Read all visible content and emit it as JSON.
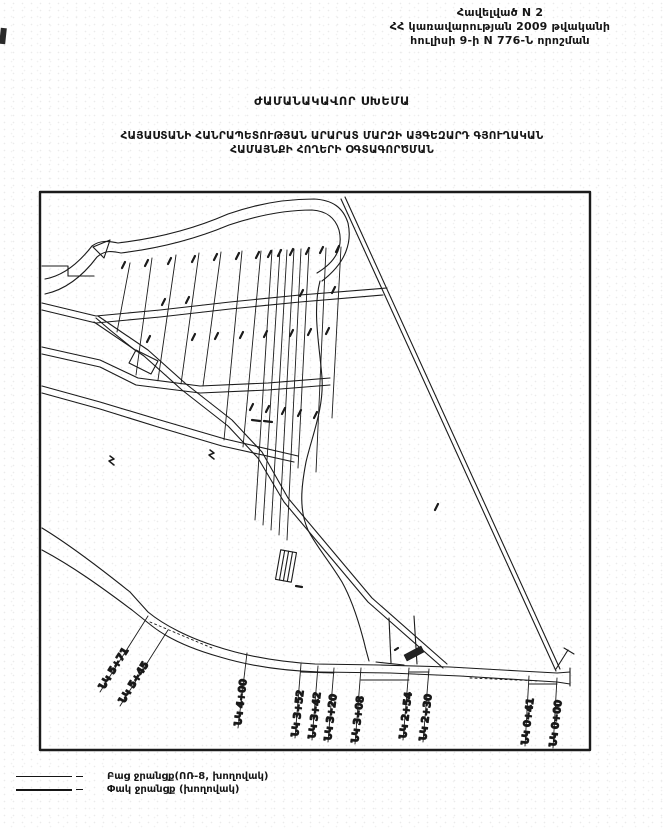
{
  "page": {
    "header": {
      "line1": "Հավելված N 2",
      "line2": "ՀՀ կառավարության 2009 թվականի",
      "line3": "հուլիսի 9-ի N 776-Ն որոշման"
    },
    "title": "ԺԱՄԱՆԱԿԱՎՈՐ ՍԽԵՄԱ",
    "subtitle_line1": "ՀԱՅԱՍՏԱՆԻ ՀԱՆՐԱՊԵՏՈՒԹՅԱՆ ԱՐԱՐԱՏ ՄԱՐԶԻ ԱՅԳԵԶԱՐԴ ԳՅՈՒՂԱԿԱՆ",
    "subtitle_line2": "ՀԱՄԱՅՆՔԻ ՀՈՂԵՐԻ ՕԳՏԱԳՈՐԾՄԱՆ"
  },
  "map": {
    "pickets": [
      {
        "label": "ՆԿ 5+71"
      },
      {
        "label": "ՆԿ 5+45"
      },
      {
        "label": "ՆԿ 4+00"
      },
      {
        "label": "ՆԿ 3+52"
      },
      {
        "label": "ՆԿ 3+42"
      },
      {
        "label": "ՆԿ 3+20"
      },
      {
        "label": "ՆԿ 3+08"
      },
      {
        "label": "ՆԿ 2+54"
      },
      {
        "label": "ՆԿ 2+30"
      },
      {
        "label": "ՆԿ 0+41"
      },
      {
        "label": "ՆԿ 0+00"
      }
    ]
  },
  "legend": {
    "items": [
      {
        "label": "Բաց ջրանցք(ՈՌ-8, խողովակ)"
      },
      {
        "label": "Փակ ջրանցք (խողովակ)"
      }
    ]
  },
  "colors": {
    "ink": "#161616",
    "paper": "#ffffff"
  }
}
